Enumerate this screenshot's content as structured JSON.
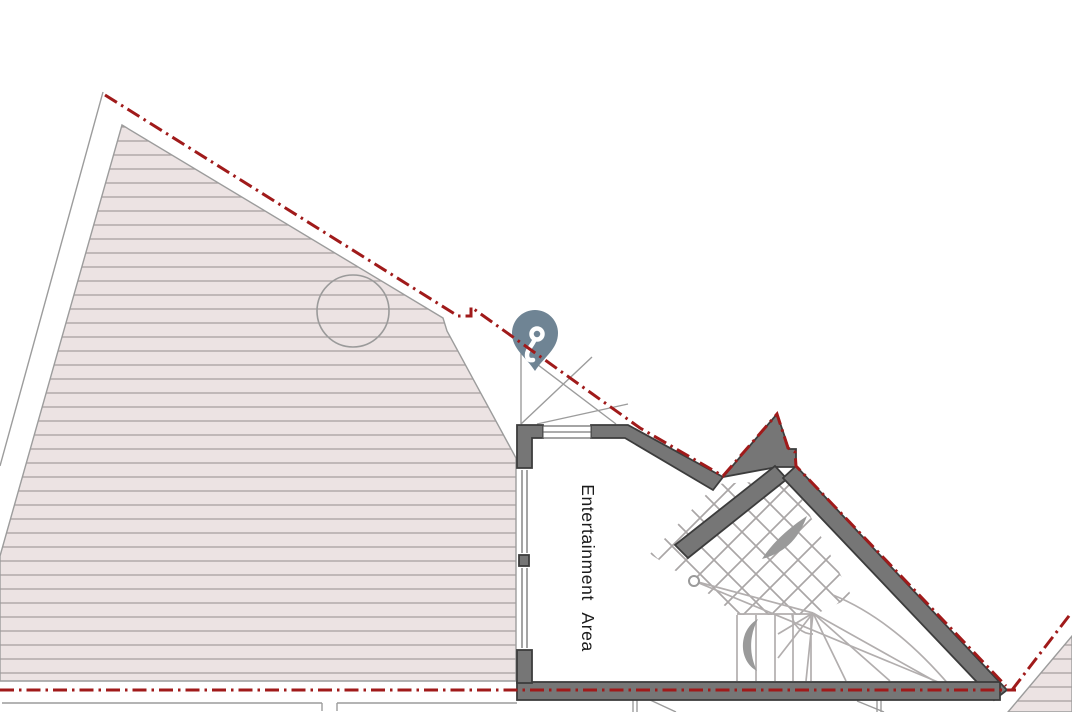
{
  "plan": {
    "title": "floor-plan-view",
    "room_label": "Entertainment Area",
    "marker": {
      "icon": "key-icon",
      "pin_color": "#6f8494",
      "glyph_color": "#ffffff"
    },
    "colors": {
      "boundary_red": "#a01a1a",
      "wall_gray": "#767676",
      "wall_edge": "#3c3c3c",
      "deck_hatch_background": "#ece3e3",
      "deck_hatch_line": "#a9a1a1",
      "stair_line": "#b2aeae",
      "outline_gray": "#9c9c9c",
      "background": "#ffffff"
    }
  }
}
